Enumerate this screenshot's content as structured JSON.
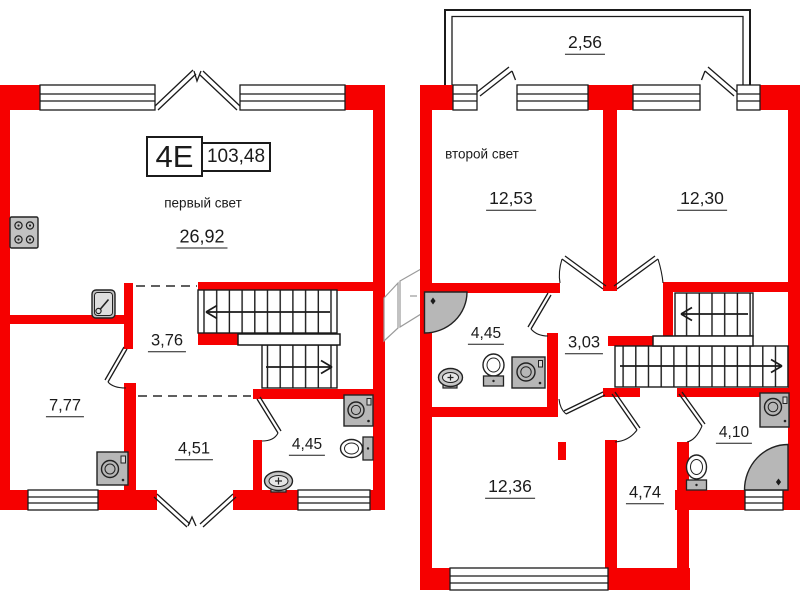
{
  "colors": {
    "wall": "#f60000",
    "line": "#1b1b1b",
    "fixture_fill": "#b7b7b7"
  },
  "unit": {
    "number": "4E",
    "total_area": "103,48"
  },
  "floor1": {
    "caption": "первый свет",
    "rooms": {
      "living": "26,92",
      "hall": "3,76",
      "room": "7,77",
      "corridor": "4,51",
      "bathroom": "4,45"
    }
  },
  "floor2": {
    "caption": "второй свет",
    "rooms": {
      "balcony": "2,56",
      "bedroom_left": "12,53",
      "bedroom_right": "12,30",
      "bathroom_upper": "4,45",
      "hall": "3,03",
      "bedroom_lower": "12,36",
      "room": "4,74",
      "bathroom_lower": "4,10"
    }
  }
}
